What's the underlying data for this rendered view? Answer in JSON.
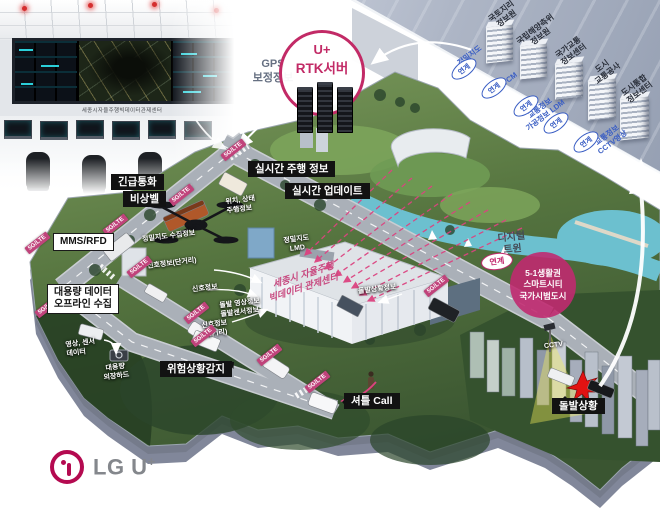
{
  "branding": {
    "logo_main": "LG U",
    "logo_plus": "+"
  },
  "control_room": {
    "caption": "세종시자율주행빅데이터관제센터"
  },
  "rtk_server": {
    "line1": "U+",
    "line2": "RTK서버"
  },
  "gps": {
    "line1": "GPS",
    "line2": "보정정보"
  },
  "panel": {
    "agencies": [
      {
        "line1": "국토지리",
        "line2": "정보원"
      },
      {
        "line1": "국립해양측위",
        "line2": "정보원"
      },
      {
        "line1": "국가교통",
        "line2": "정보센터"
      },
      {
        "line1": "도시",
        "line2": "교통공사"
      },
      {
        "line1": "도시통합",
        "line2": "정보센터"
      }
    ],
    "link_badge": "연계",
    "data_types": [
      {
        "line1": "정밀지도",
        "line2": ""
      },
      {
        "line1": "RTCM",
        "line2": ""
      },
      {
        "line1": "교통정보",
        "line2": "가공정보 LDM"
      },
      {
        "line1": "교통정보",
        "line2": "CCTV영상"
      }
    ]
  },
  "labels": {
    "realtime_driving": "실시간 주행 정보",
    "realtime_update": "실시간 업데이트",
    "emergency_call": "긴급통화",
    "emergency_bell": "비상벨",
    "mms_rfd": "MMS/RFD",
    "bigdata_line1": "대용량 데이터",
    "bigdata_line2": "오프라인 수집",
    "danger_detect": "위험상황감지",
    "shuttle_call": "셔틀 Call",
    "incident": "돌발상황"
  },
  "map_texts": {
    "pos_status_line1": "위치, 상태",
    "pos_status_line2": "주행정보",
    "precision_collect": "정밀지도 수집정보",
    "signal_short": "신호정보(단거리)",
    "signal": "신호정보",
    "incident_video_line1": "돌발 영상정보",
    "incident_video_line2": "돌발센서정보",
    "signal_long_line1": "신호정보",
    "signal_long_line2": "(장거리)",
    "precision_line1": "정밀지도",
    "precision_line2": "LMD",
    "incident_info": "돌발상황정보",
    "sensor_line1": "영상, 센서",
    "sensor_line2": "데이터",
    "hdd_line1": "대용량",
    "hdd_line2": "외장하드",
    "cctv": "CCTV"
  },
  "network_tag": "5G/LTE",
  "control_center_building": {
    "line1": "세종시 자율주행",
    "line2": "빅데이터 관제센터"
  },
  "digital_twin": {
    "line1": "디지털",
    "line2": "트윈",
    "link_badge": "연계"
  },
  "smart_city": {
    "line1": "5-1생활권",
    "line2": "스마트시티",
    "line3": "국가시범도시"
  },
  "colors": {
    "magenta": "#c2286e",
    "link_blue": "#3a5ec4",
    "label_black": "#121212"
  }
}
